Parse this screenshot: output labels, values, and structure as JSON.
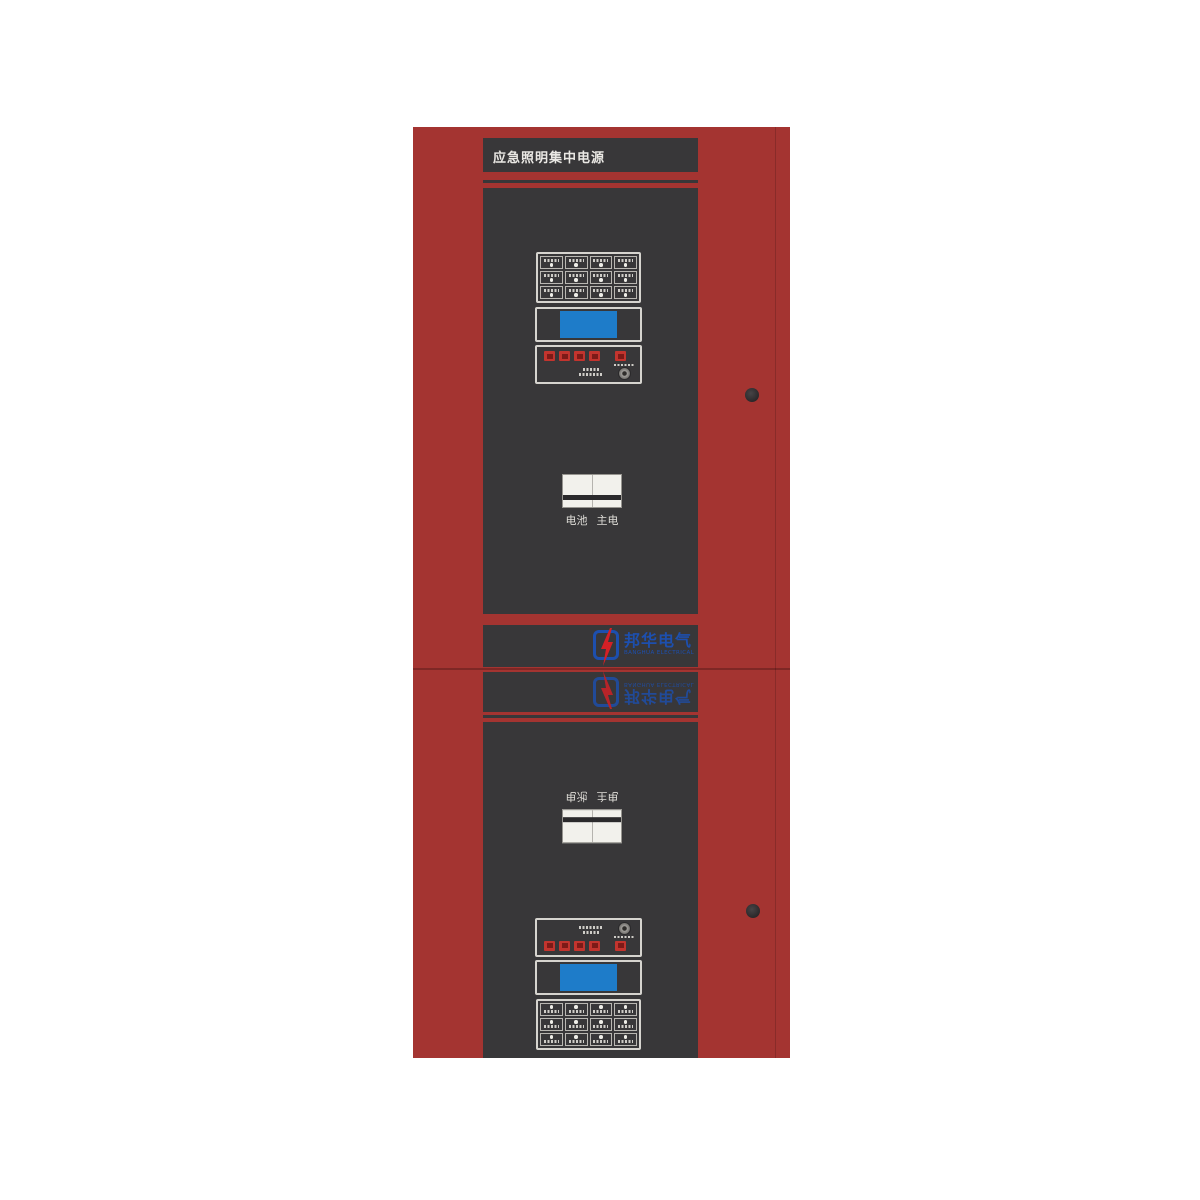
{
  "device": {
    "title": "应急照明集中电源",
    "logo": {
      "name_cn": "邦华电气",
      "name_en": "BANGHUA ELECTRICAL"
    },
    "breaker_labels": {
      "left": "电池",
      "right": "主电"
    },
    "indicator_grid": {
      "rows": 3,
      "columns": 4
    },
    "control_buttons": {
      "left_group_count": 4,
      "right_count": 1
    },
    "screw_count": 2,
    "colors": {
      "frame_red": "#a43431",
      "panel_dark": "#383739",
      "seam_red": "#7e2725",
      "lcd_blue": "#1e7cc9",
      "button_red": "#c2342e",
      "logo_blue": "#1d4fae",
      "bolt_red": "#d42026"
    }
  }
}
